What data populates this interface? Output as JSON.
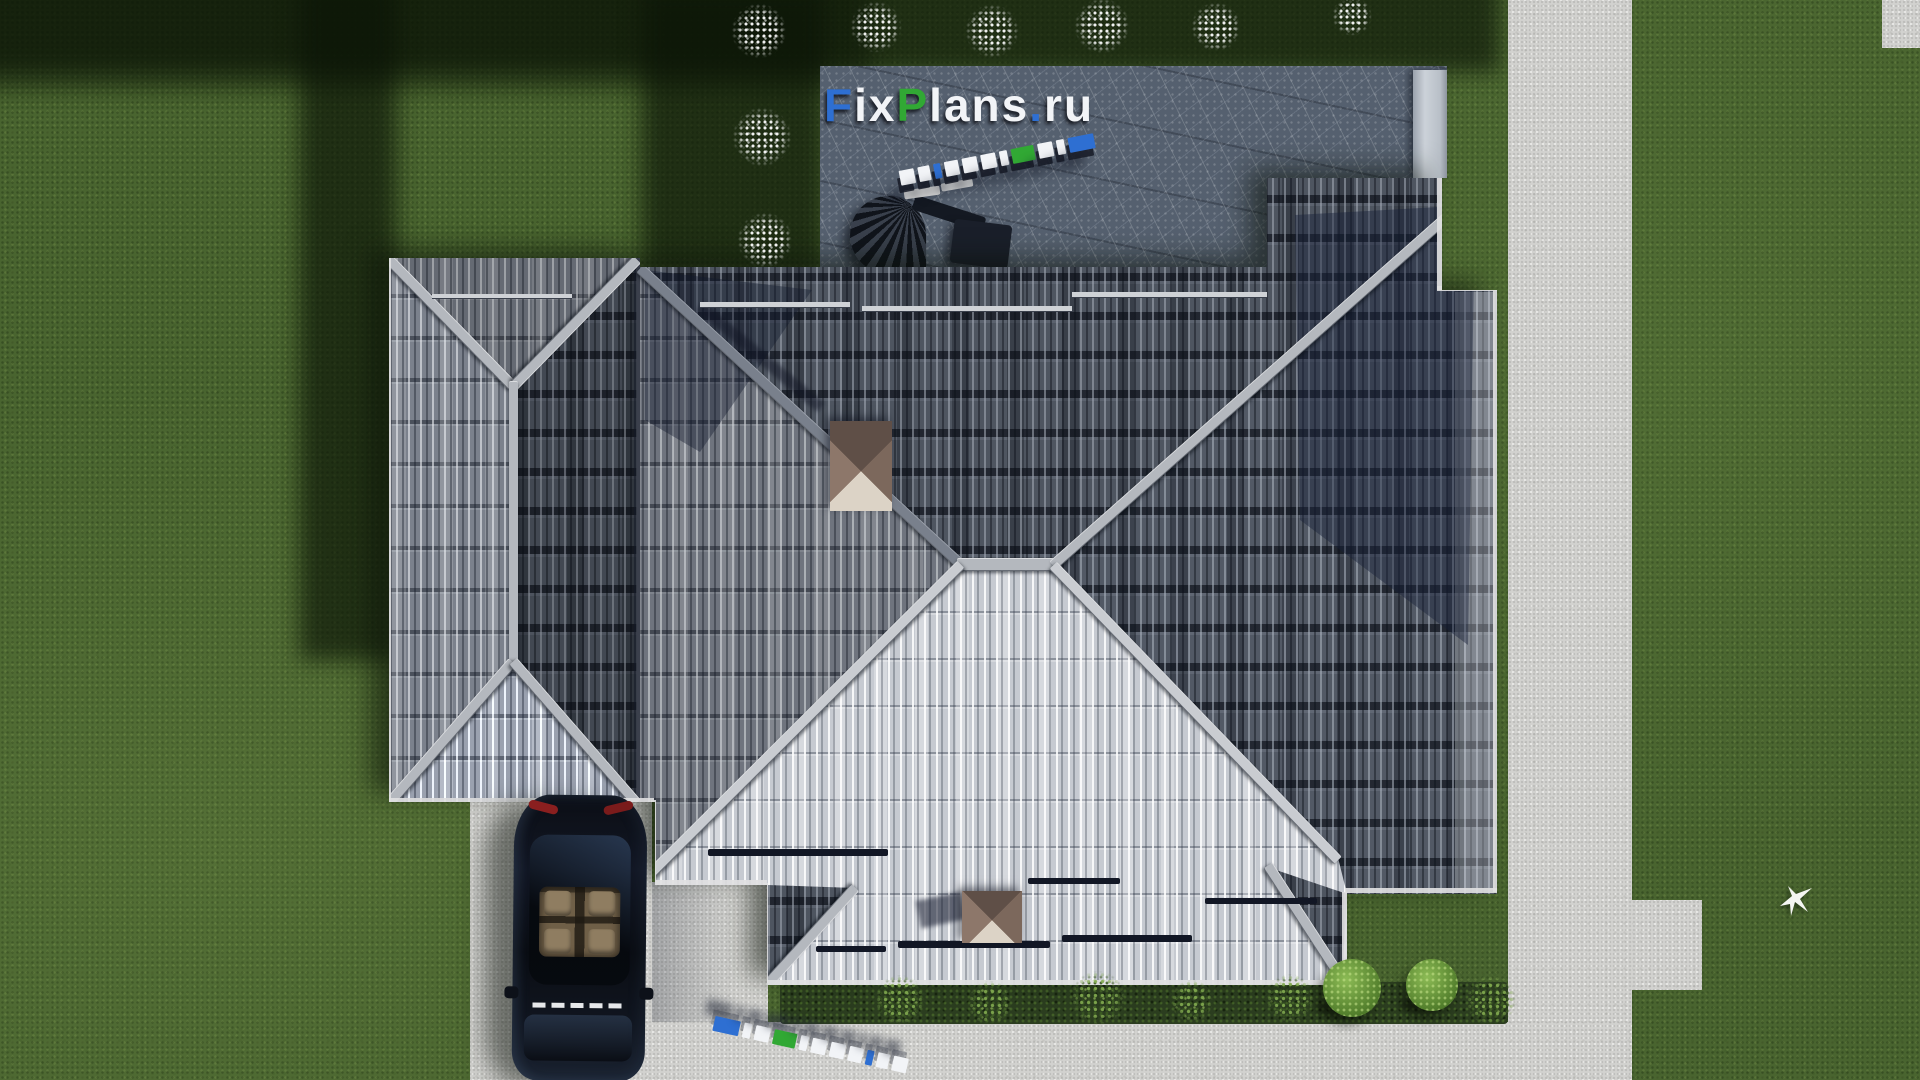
{
  "watermark": {
    "text": "FixPlans.ru",
    "letters": [
      {
        "ch": "F",
        "color": "#2e6fd2"
      },
      {
        "ch": "i",
        "color": "#f2f4f7"
      },
      {
        "ch": "x",
        "color": "#f2f4f7"
      },
      {
        "ch": "P",
        "color": "#31a834"
      },
      {
        "ch": "l",
        "color": "#f2f4f7"
      },
      {
        "ch": "a",
        "color": "#f2f4f7"
      },
      {
        "ch": "n",
        "color": "#f2f4f7"
      },
      {
        "ch": "s",
        "color": "#f2f4f7"
      },
      {
        "ch": ".",
        "color": "#2e6fd2"
      },
      {
        "ch": "r",
        "color": "#f2f4f7"
      },
      {
        "ch": "u",
        "color": "#f2f4f7"
      }
    ]
  },
  "colors": {
    "grass": "#49642f",
    "grass_shadow": "#16230f",
    "pavement": "#d2d2cf",
    "patio_slate": "#55606f",
    "roof_bright": "#c6cad1",
    "roof_dark": "#4e5560",
    "roof_medium": "#7b818c",
    "ridge": "#b4b8be",
    "chimney_tan": "#8d776a",
    "car_body": "#0c1018",
    "accent_blue": "#2e6fd2",
    "accent_green": "#31a834"
  }
}
